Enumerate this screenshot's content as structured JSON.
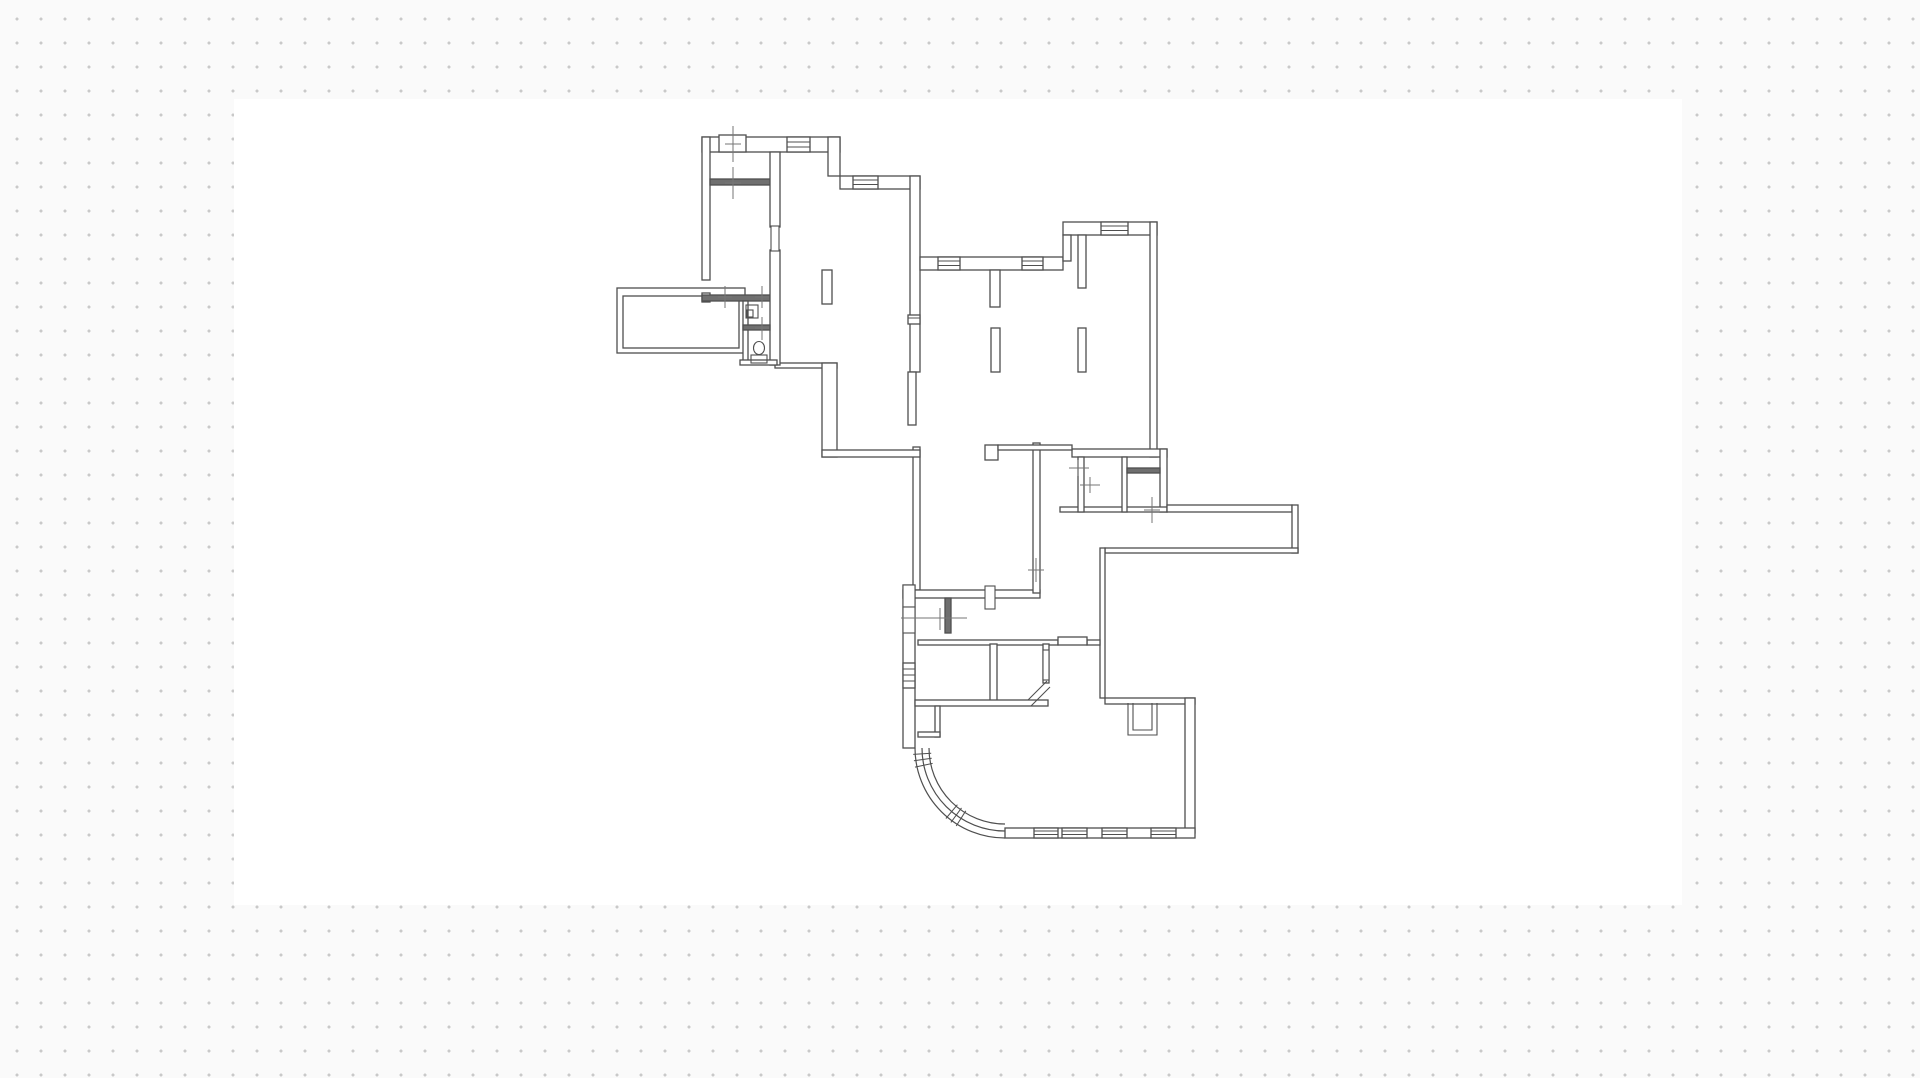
{
  "app": {
    "background_color": "#fafafa",
    "dot_color": "#c9c9c9",
    "dot_spacing_px": 24,
    "dot_radius_px": 1.4,
    "dot_offset_x": 5,
    "dot_offset_y": 7
  },
  "sheet": {
    "x": 234,
    "y": 99,
    "width": 1448,
    "height": 806,
    "color": "#ffffff"
  },
  "floor_plan": {
    "stroke": "#4f4f4f",
    "solid_fill": "#6f6f6f",
    "line_width": 1.3,
    "dim_color": "#757575",
    "outer_walls": [
      {
        "x": 702,
        "y": 137,
        "w": 138,
        "h": 15
      },
      {
        "x": 828,
        "y": 137,
        "w": 12,
        "h": 39
      },
      {
        "x": 840,
        "y": 176,
        "w": 80,
        "h": 13
      },
      {
        "x": 702,
        "y": 137,
        "w": 8,
        "h": 143
      },
      {
        "x": 702,
        "y": 293,
        "w": 8,
        "h": 9
      },
      {
        "x": 617,
        "y": 288,
        "w": 128,
        "h": 65,
        "hollow": true
      },
      {
        "x": 623,
        "y": 296,
        "w": 116,
        "h": 52,
        "hollow": true
      },
      {
        "x": 910,
        "y": 176,
        "w": 10,
        "h": 196
      },
      {
        "x": 908,
        "y": 372,
        "w": 8,
        "h": 53
      },
      {
        "x": 913,
        "y": 447,
        "w": 7,
        "h": 143
      },
      {
        "x": 775,
        "y": 363,
        "w": 62,
        "h": 5
      },
      {
        "x": 822,
        "y": 363,
        "w": 15,
        "h": 94
      },
      {
        "x": 822,
        "y": 450,
        "w": 98,
        "h": 7
      },
      {
        "x": 920,
        "y": 257,
        "w": 143,
        "h": 13
      },
      {
        "x": 1063,
        "y": 222,
        "w": 94,
        "h": 13
      },
      {
        "x": 1063,
        "y": 235,
        "w": 8,
        "h": 26
      },
      {
        "x": 1150,
        "y": 222,
        "w": 7,
        "h": 235
      },
      {
        "x": 1072,
        "y": 449,
        "w": 95,
        "h": 8
      },
      {
        "x": 1160,
        "y": 449,
        "w": 7,
        "h": 63
      },
      {
        "x": 1060,
        "y": 507,
        "w": 107,
        "h": 5
      },
      {
        "x": 1167,
        "y": 505,
        "w": 125,
        "h": 7
      },
      {
        "x": 1292,
        "y": 505,
        "w": 6,
        "h": 48
      },
      {
        "x": 1105,
        "y": 548,
        "w": 193,
        "h": 5
      },
      {
        "x": 1100,
        "y": 548,
        "w": 5,
        "h": 150
      },
      {
        "x": 903,
        "y": 590,
        "w": 137,
        "h": 8
      },
      {
        "x": 903,
        "y": 585,
        "w": 12,
        "h": 163
      },
      {
        "x": 1105,
        "y": 698,
        "w": 90,
        "h": 6
      },
      {
        "x": 1185,
        "y": 698,
        "w": 10,
        "h": 135
      },
      {
        "x": 1005,
        "y": 828,
        "w": 190,
        "h": 10
      },
      {
        "x": 1033,
        "y": 443,
        "w": 7,
        "h": 150
      }
    ],
    "interior_walls": [
      {
        "x": 710,
        "y": 179,
        "w": 63,
        "h": 6,
        "solid": true
      },
      {
        "x": 702,
        "y": 295,
        "w": 73,
        "h": 6,
        "solid": true
      },
      {
        "x": 770,
        "y": 152,
        "w": 10,
        "h": 75
      },
      {
        "x": 770,
        "y": 250,
        "w": 10,
        "h": 115
      },
      {
        "x": 743,
        "y": 301,
        "w": 5,
        "h": 62
      },
      {
        "x": 743,
        "y": 325,
        "w": 27,
        "h": 5,
        "solid": true
      },
      {
        "x": 740,
        "y": 360,
        "w": 37,
        "h": 5
      },
      {
        "x": 1078,
        "y": 235,
        "w": 8,
        "h": 53
      },
      {
        "x": 985,
        "y": 445,
        "w": 13,
        "h": 15
      },
      {
        "x": 998,
        "y": 445,
        "w": 74,
        "h": 5
      },
      {
        "x": 1078,
        "y": 457,
        "w": 6,
        "h": 55
      },
      {
        "x": 1122,
        "y": 457,
        "w": 5,
        "h": 55
      },
      {
        "x": 1127,
        "y": 468,
        "w": 33,
        "h": 5,
        "solid": true
      },
      {
        "x": 945,
        "y": 598,
        "w": 6,
        "h": 35,
        "solid": true
      },
      {
        "x": 918,
        "y": 640,
        "w": 140,
        "h": 5
      },
      {
        "x": 1087,
        "y": 640,
        "w": 13,
        "h": 5
      },
      {
        "x": 1058,
        "y": 637,
        "w": 29,
        "h": 8
      },
      {
        "x": 990,
        "y": 644,
        "w": 7,
        "h": 58
      },
      {
        "x": 1043,
        "y": 644,
        "w": 6,
        "h": 39
      },
      {
        "x": 915,
        "y": 700,
        "w": 133,
        "h": 6
      },
      {
        "x": 935,
        "y": 706,
        "w": 5,
        "h": 31
      },
      {
        "x": 918,
        "y": 732,
        "w": 22,
        "h": 5
      }
    ],
    "columns": [
      {
        "x": 822,
        "y": 270,
        "w": 10,
        "h": 34
      },
      {
        "x": 990,
        "y": 270,
        "w": 10,
        "h": 37
      },
      {
        "x": 991,
        "y": 328,
        "w": 9,
        "h": 44
      },
      {
        "x": 1078,
        "y": 328,
        "w": 8,
        "h": 44
      }
    ],
    "windows": [
      {
        "rect": [
          719,
          135,
          27,
          17
        ],
        "lines": []
      },
      {
        "rect": [
          787,
          137,
          23,
          15
        ],
        "lines": [
          [
            787,
            142,
            810,
            142
          ],
          [
            787,
            147,
            810,
            147
          ]
        ]
      },
      {
        "rect": [
          853,
          176,
          25,
          13
        ],
        "lines": [
          [
            853,
            180,
            878,
            180
          ],
          [
            853,
            184.5,
            878,
            184.5
          ]
        ]
      },
      {
        "rect": [
          938,
          257,
          22,
          13
        ],
        "lines": [
          [
            938,
            261,
            960,
            261
          ],
          [
            938,
            265.5,
            960,
            265.5
          ]
        ]
      },
      {
        "rect": [
          1022,
          257,
          21,
          13
        ],
        "lines": [
          [
            1022,
            261,
            1043,
            261
          ],
          [
            1022,
            265.5,
            1043,
            265.5
          ]
        ]
      },
      {
        "rect": [
          1101,
          222,
          27,
          13
        ],
        "lines": [
          [
            1101,
            226,
            1128,
            226
          ],
          [
            1101,
            230.5,
            1128,
            230.5
          ]
        ]
      },
      {
        "rect": [
          1034,
          828,
          24,
          10
        ],
        "lines": [
          [
            1034,
            831,
            1058,
            831
          ],
          [
            1034,
            834.5,
            1058,
            834.5
          ]
        ]
      },
      {
        "rect": [
          1062,
          828,
          25,
          10
        ],
        "lines": [
          [
            1062,
            831,
            1087,
            831
          ],
          [
            1062,
            834.5,
            1087,
            834.5
          ]
        ]
      },
      {
        "rect": [
          1102,
          828,
          25,
          10
        ],
        "lines": [
          [
            1102,
            831,
            1127,
            831
          ],
          [
            1102,
            834.5,
            1127,
            834.5
          ]
        ]
      },
      {
        "rect": [
          1151,
          828,
          25,
          10
        ],
        "lines": [
          [
            1151,
            831,
            1176,
            831
          ],
          [
            1151,
            834.5,
            1176,
            834.5
          ]
        ]
      },
      {
        "rect": [
          903,
          663,
          12,
          25
        ],
        "lines": [
          [
            903,
            669,
            915,
            669
          ],
          [
            903,
            675,
            915,
            675
          ],
          [
            903,
            681,
            915,
            681
          ]
        ]
      },
      {
        "rect": [
          908,
          315,
          12,
          9
        ],
        "lines": [
          [
            908,
            318,
            920,
            318
          ]
        ]
      }
    ],
    "door_jambs": [
      {
        "x": 771,
        "y": 226,
        "w": 8,
        "h": 25
      },
      {
        "x": 985,
        "y": 586,
        "w": 10,
        "h": 23
      },
      {
        "x": 903,
        "y": 585,
        "w": 12,
        "h": 22
      },
      {
        "x": 903,
        "y": 607,
        "w": 12,
        "h": 26
      },
      {
        "x": 1043,
        "y": 650,
        "w": 6,
        "h": 30
      }
    ],
    "fixtures": [
      {
        "kind": "rect",
        "x": 746,
        "y": 305,
        "w": 12,
        "h": 13
      },
      {
        "kind": "rect",
        "x": 747,
        "y": 310,
        "w": 6,
        "h": 7
      },
      {
        "kind": "ellipse",
        "cx": 759,
        "cy": 348,
        "rx": 5.5,
        "ry": 6.5
      },
      {
        "kind": "rect",
        "x": 751,
        "y": 355,
        "w": 16,
        "h": 8
      },
      {
        "kind": "path",
        "d": "M1128,703 L1128,735 L1157,735 L1157,703"
      },
      {
        "kind": "path",
        "d": "M1133,703 L1133,730 L1152,730 L1152,703"
      },
      {
        "kind": "line",
        "x1": 1028,
        "y1": 700,
        "x2": 1047,
        "y2": 681
      },
      {
        "kind": "line",
        "x1": 1031,
        "y1": 706,
        "x2": 1050,
        "y2": 687
      }
    ],
    "curved_wall": {
      "arcs": [
        "M915,748 A90,90 0 0 0 1005,838",
        "M922,748 A83,83 0 0 0 1005,831",
        "M929,748 A76,76 0 0 0 1005,824"
      ],
      "hatches": [
        [
          931.2,
          753.2,
          913.2,
          754.4
        ],
        [
          931.7,
          758.3,
          913.9,
          760.8
        ],
        [
          932.6,
          763.4,
          915.0,
          767.1
        ],
        [
          957.4,
          804.7,
          945.9,
          818.5
        ],
        [
          961.5,
          807.9,
          950.9,
          822.4
        ],
        [
          965.8,
          810.8,
          956.2,
          826.0
        ]
      ]
    },
    "dimension_marks": [
      [
        733,
        126,
        733,
        162
      ],
      [
        725,
        144,
        741,
        144
      ],
      [
        733,
        167,
        733,
        199
      ],
      [
        725,
        183,
        741,
        183
      ],
      [
        725,
        286,
        725,
        308
      ],
      [
        718,
        297,
        732,
        297
      ],
      [
        762,
        286,
        762,
        308
      ],
      [
        755,
        297,
        769,
        297
      ],
      [
        762,
        317,
        762,
        340
      ],
      [
        755,
        328,
        769,
        328
      ],
      [
        901,
        618,
        967,
        618
      ],
      [
        940,
        608,
        940,
        630
      ],
      [
        1152,
        497,
        1152,
        523
      ],
      [
        1144,
        510,
        1160,
        510
      ],
      [
        1069,
        468,
        1089,
        468
      ],
      [
        1078,
        460,
        1078,
        476
      ],
      [
        1080,
        485,
        1100,
        485
      ],
      [
        1090,
        477,
        1090,
        493
      ],
      [
        1036,
        558,
        1036,
        582
      ],
      [
        1028,
        570,
        1044,
        570
      ]
    ]
  }
}
